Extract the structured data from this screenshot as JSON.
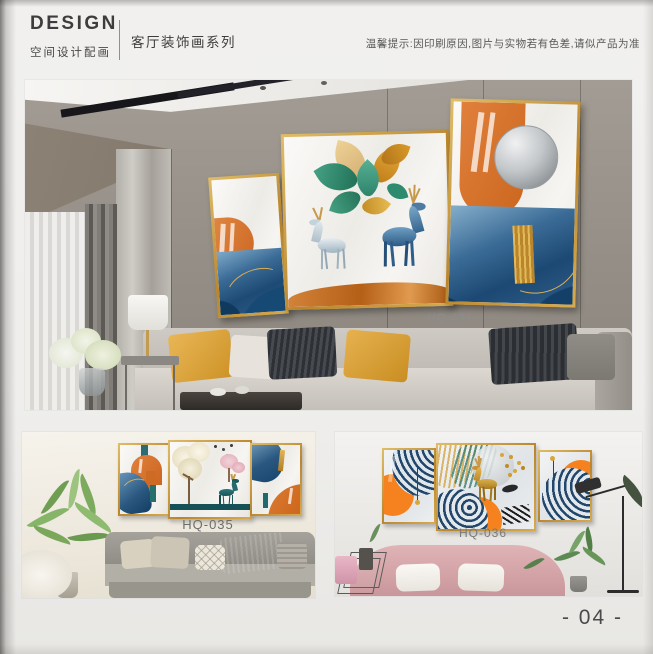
{
  "header": {
    "brand": "DESIGN",
    "brand_subtitle": "空间设计配画",
    "series_title": "客厅装饰画系列",
    "notice": "温馨提示:因印刷原因,图片与实物若有色差,请似产品为准"
  },
  "products": [
    {
      "code": "HQ-034",
      "scene": "living-room-gray-wall",
      "pieces": 3
    },
    {
      "code": "HQ-035",
      "scene": "gray-sofa-room",
      "pieces": 3
    },
    {
      "code": "HQ-036",
      "scene": "pink-sofa-room",
      "pieces": 3
    }
  ],
  "footer": {
    "page_number": "- 04 -"
  },
  "colors": {
    "gold_frame": "#c9a24b",
    "accent_orange": "#d9712b",
    "vivid_orange": "#f5821f",
    "accent_blue": "#2f6390",
    "accent_teal": "#2e8b74",
    "navy": "#23476b"
  }
}
